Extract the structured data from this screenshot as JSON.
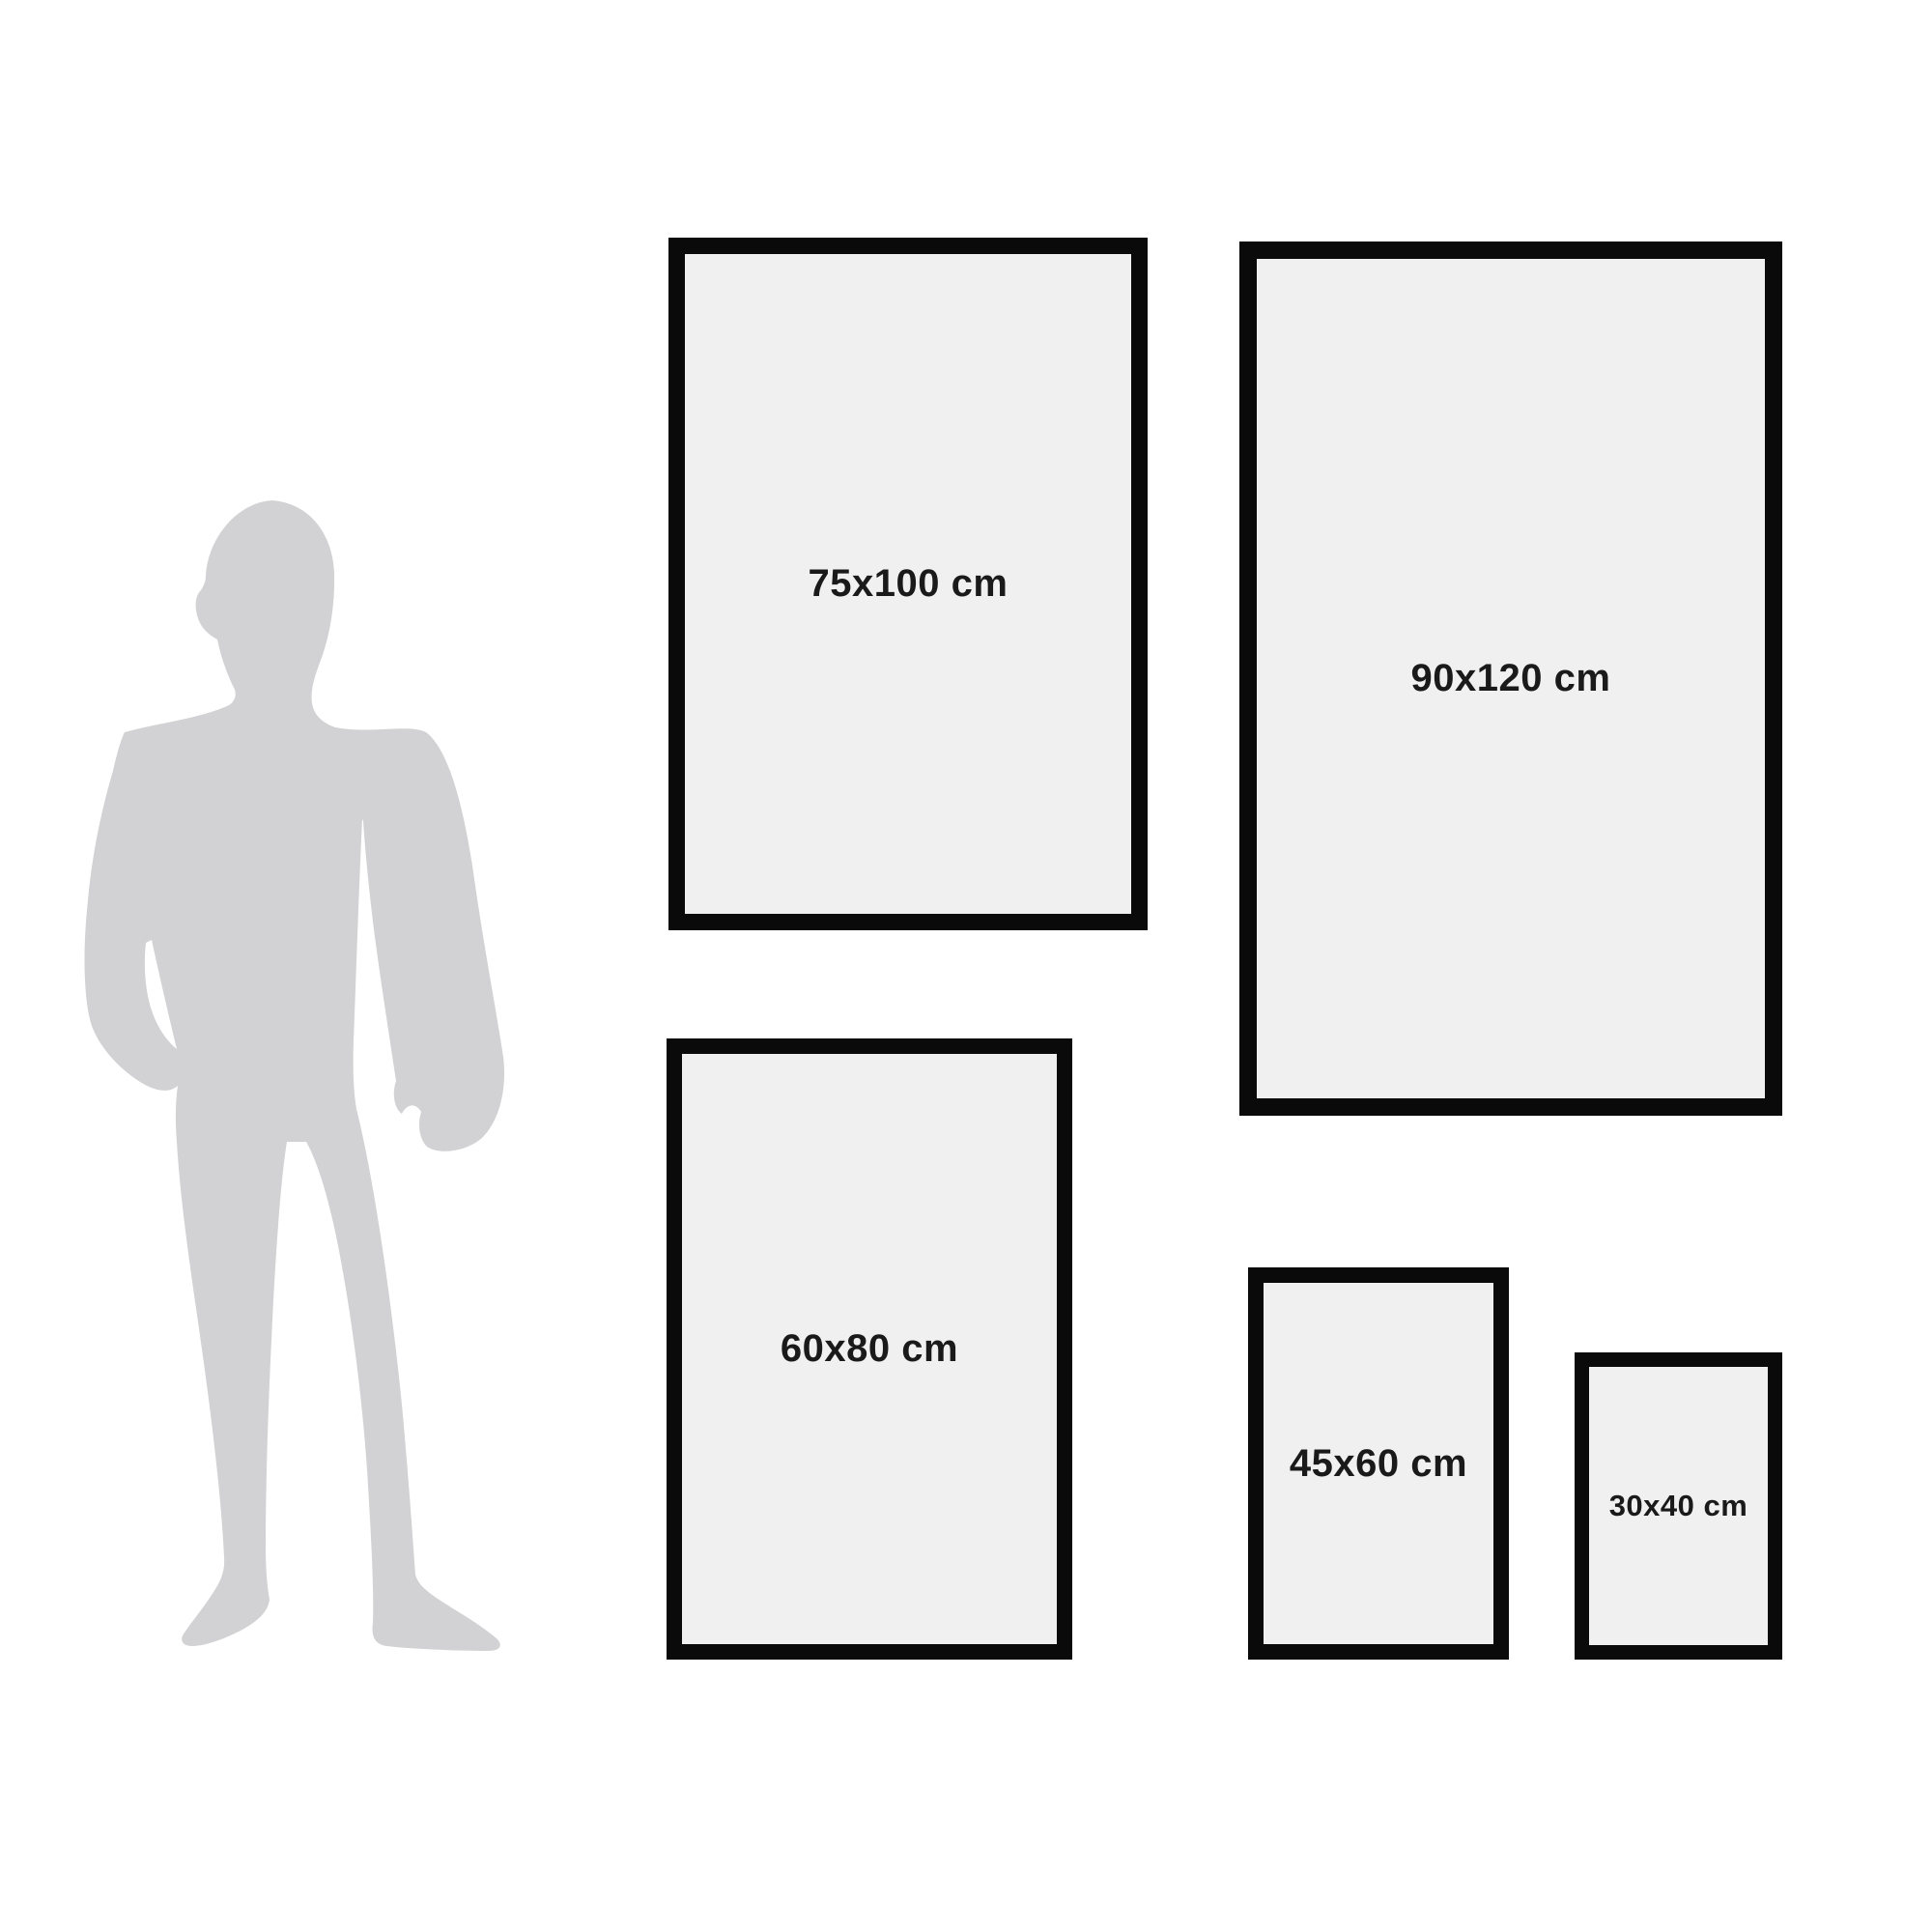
{
  "page": {
    "background": "#ffffff",
    "title": "Frame size comparison guide"
  },
  "size_guide": {
    "person": {
      "icon": "standing-man-silhouette",
      "color": "#d2d2d4"
    },
    "frames": [
      {
        "size": "75x100",
        "label": "75x100 cm"
      },
      {
        "size": "90x120",
        "label": "90x120 cm"
      },
      {
        "size": "60x80",
        "label": "60x80 cm"
      },
      {
        "size": "45x60",
        "label": "45x60 cm"
      },
      {
        "size": "30x40",
        "label": "30x40 cm"
      }
    ],
    "colors": {
      "frame_border": "#0a0a0a",
      "frame_fill": "#f0f0f0",
      "label_text": "#1a1a1a",
      "silhouette": "#d2d2d4",
      "background": "#ffffff"
    }
  }
}
